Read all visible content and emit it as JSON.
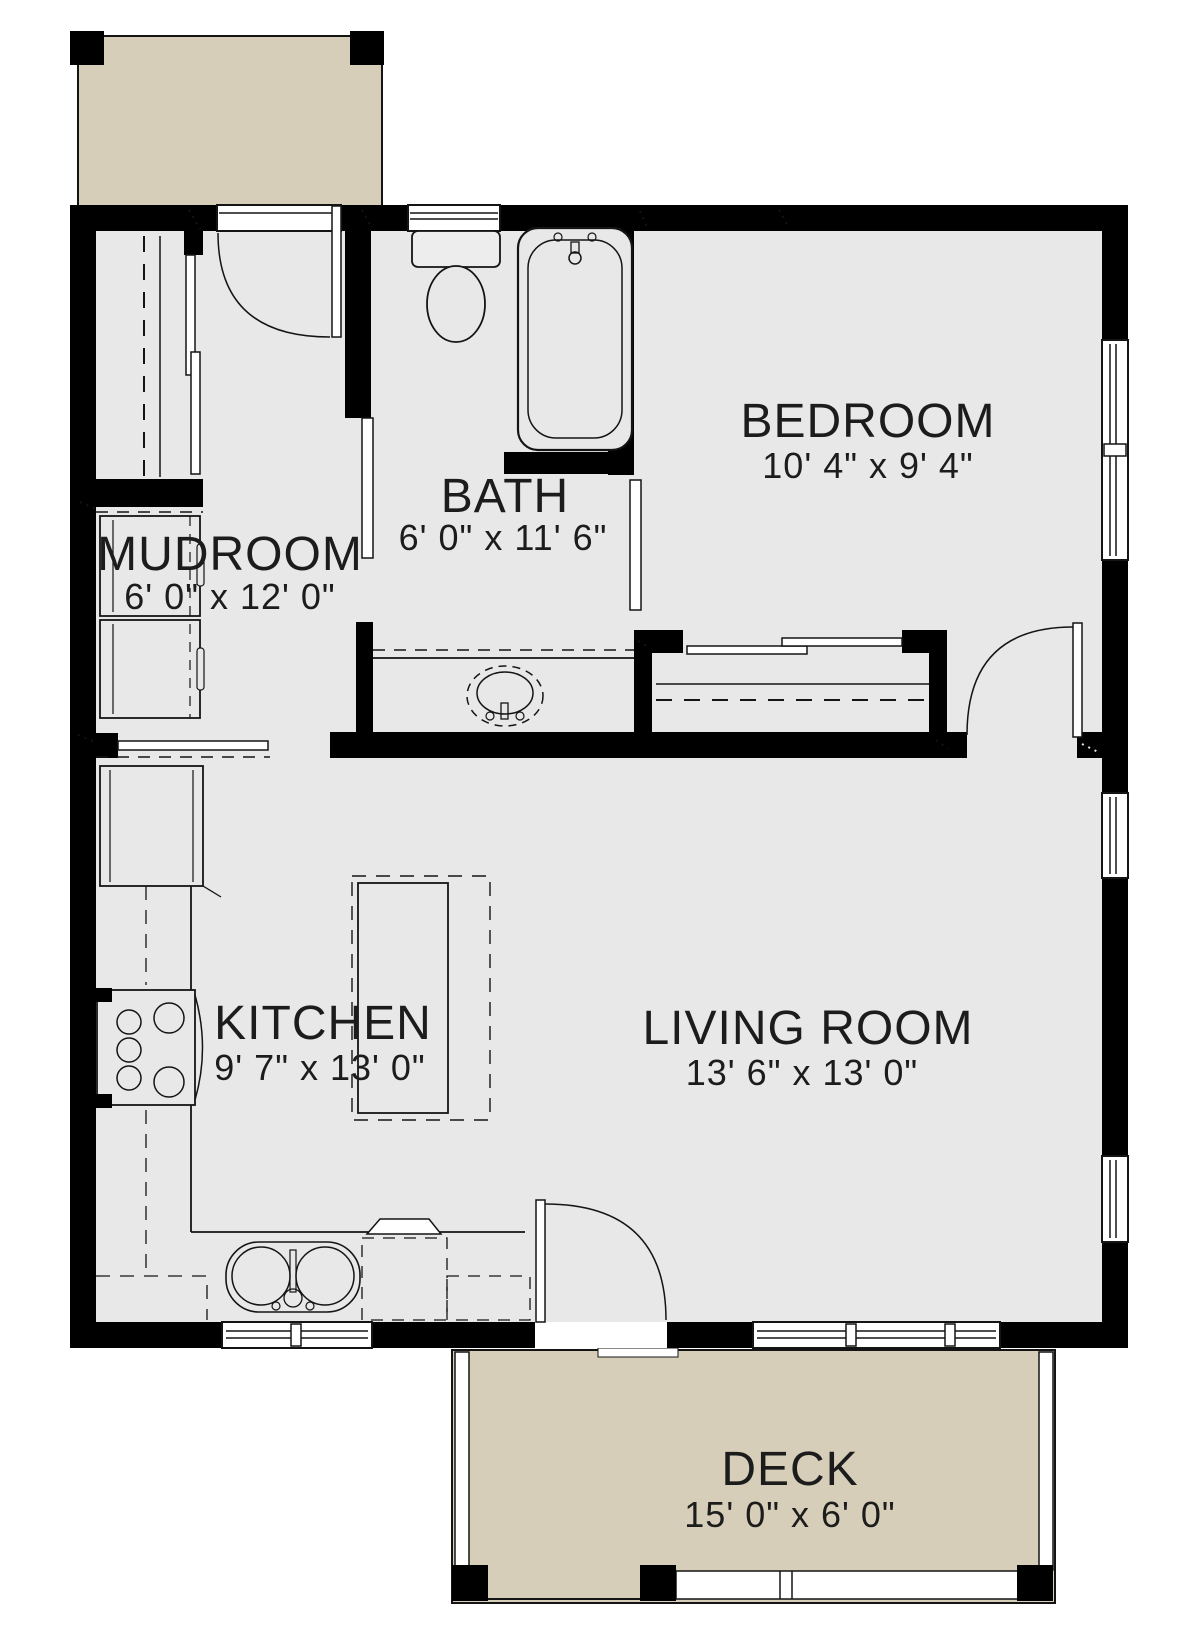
{
  "plan": {
    "type": "floor-plan",
    "rooms": [
      {
        "name": "MUDROOM",
        "dims": "6' 0\" x 12' 0\""
      },
      {
        "name": "BATH",
        "dims": "6' 0\" x 11' 6\""
      },
      {
        "name": "BEDROOM",
        "dims": "10' 4\" x 9' 4\""
      },
      {
        "name": "KITCHEN",
        "dims": "9' 7\" x 13' 0\""
      },
      {
        "name": "LIVING ROOM",
        "dims": "13' 6\" x 13' 0\""
      },
      {
        "name": "DECK",
        "dims": "15' 0\" x 6' 0\""
      }
    ],
    "fixtures": [
      "entry-door",
      "pocket-door-bath",
      "pocket-door-bedroom-bath",
      "bedroom-door",
      "deck-door",
      "mudroom-coat-closet",
      "bedroom-closet-bypass-doors",
      "washer",
      "dryer",
      "refrigerator",
      "range",
      "kitchen-island",
      "double-bowl-sink",
      "dishwasher",
      "vanity-sink",
      "toilet",
      "bathtub",
      "porch-posts",
      "deck-posts",
      "deck-railing"
    ],
    "windows": [
      "bath-top-wall",
      "bedroom-right-wall",
      "living-room-right-upper",
      "living-room-right-lower",
      "kitchen-bottom-wall",
      "living-room-bottom-wall"
    ],
    "colors": {
      "wall": "#000000",
      "floor": "#e8e8e8",
      "outdoor": "#d6ceb9",
      "background": "#ffffff",
      "line": "#141414"
    }
  }
}
